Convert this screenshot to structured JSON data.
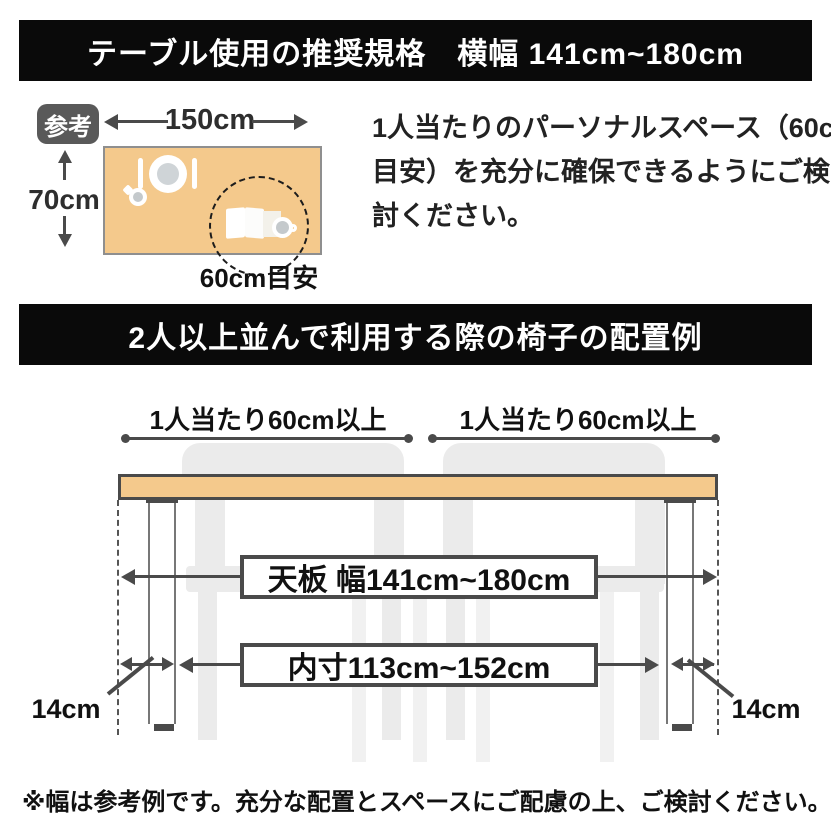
{
  "colors": {
    "banner_bg": "#0a0a0a",
    "banner_text": "#ffffff",
    "wood": "#f4c98c",
    "line": "#4a4a4a",
    "chair": "#ebebeb",
    "badge_bg": "#595959"
  },
  "banner_top": {
    "text": "テーブル使用の推奨規格　横幅 141cm~180cm"
  },
  "reference_section": {
    "badge": "参考",
    "table_width": "150cm",
    "table_depth": "70cm",
    "personal_space_label": "60cm目安",
    "icons": [
      "fork-icon",
      "plate-icon",
      "cup-icon",
      "book-icon",
      "teacup-icon"
    ],
    "note_lines": [
      "1人当たりのパーソナルスペース（60cm",
      "目安）を充分に確保できるようにご検",
      "討ください。"
    ]
  },
  "banner_chairs": {
    "text": "2人以上並んで利用する際の椅子の配置例"
  },
  "chair_layout": {
    "per_person_labels": [
      "1人当たり60cm以上",
      "1人当たり60cm以上"
    ],
    "tabletop_width_label": "天板 幅141cm~180cm",
    "inner_width_label": "内寸113cm~152cm",
    "leg_offset_labels": [
      "14cm",
      "14cm"
    ]
  },
  "footnote": "※幅は参考例です。充分な配置とスペースにご配慮の上、ご検討ください。"
}
